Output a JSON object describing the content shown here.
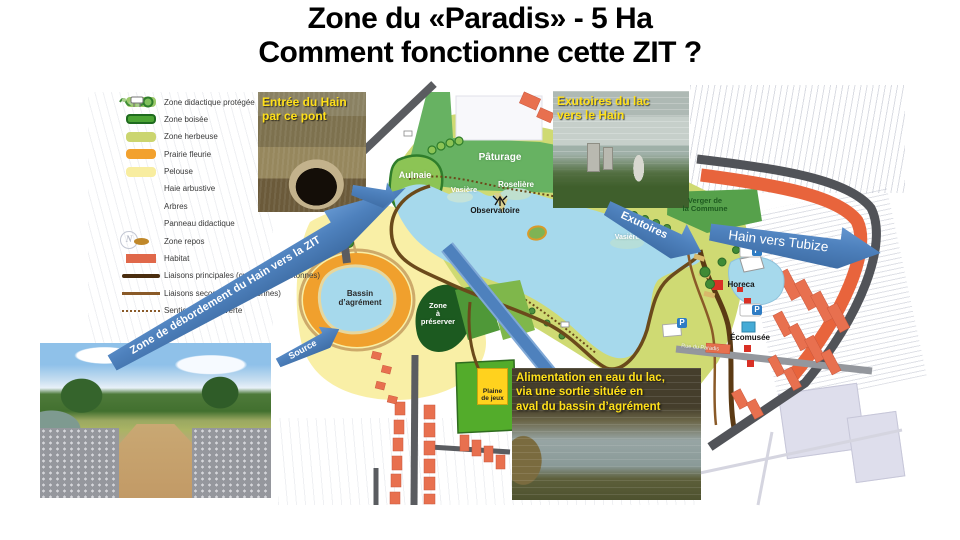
{
  "title": {
    "line1": "Zone du «Paradis» - 5 Ha",
    "line2": "Comment fonctionne cette ZIT ?"
  },
  "legend": {
    "items": [
      {
        "label": "Zone didactique protégée"
      },
      {
        "label": "Zone boisée"
      },
      {
        "label": "Zone herbeuse"
      },
      {
        "label": "Prairie fleurie"
      },
      {
        "label": "Pelouse"
      },
      {
        "label": "Haie arbustive"
      },
      {
        "label": "Arbres"
      },
      {
        "label": "Panneau didactique"
      },
      {
        "label": "Zone repos"
      },
      {
        "label": "Habitat"
      },
      {
        "label": "Liaisons principales (cyclables et piétonnes)"
      },
      {
        "label": "Liaisons secondaires (piétonnes)"
      },
      {
        "label": "Sentier de découverte"
      }
    ]
  },
  "map_labels": {
    "paturage": "Pâturage",
    "aulnaie": "Aulnaie",
    "vasiere_nord": "Vasière",
    "roseliere": "Roselière",
    "observatoire": "Observatoire",
    "vasiere_est": "Vasière",
    "verger_line1": "Verger de",
    "verger_line2": "la Commune",
    "bassin_line1": "Bassin",
    "bassin_line2": "d’agrément",
    "preserver_line1": "Zone",
    "preserver_line2": "à",
    "preserver_line3": "préserver",
    "plaine_line1": "Plaine",
    "plaine_line2": "de jeux",
    "horeca": "Horeca",
    "ecomusee": "Écomusée",
    "rue_du_paradis": "Rue du Paradis",
    "parking": "P",
    "compass": "N"
  },
  "annotations": {
    "entree_line1": "Entrée du Hain",
    "entree_line2": "par ce pont",
    "exutoires_lac_line1": "Exutoires du lac",
    "exutoires_lac_line2": "vers le Hain",
    "alimentation_line1": "Alimentation en eau du lac,",
    "alimentation_line2": "via une sortie située en",
    "alimentation_line3": "aval du bassin d’agrément",
    "debordement": "Zone de débordement du Hain vers la ZIT",
    "exutoires": "Exutoires",
    "hain_vers_tubize": "Hain vers Tubize",
    "source": "Source"
  },
  "colors": {
    "arrow_blue": "#4e81bd",
    "caption_yellow": "#ffe01a",
    "lake_blue": "#a6d9ec",
    "habitat_orange": "#e8704f",
    "pelouse_yellow": "#f9efa6",
    "pasture_green": "#67b262"
  }
}
